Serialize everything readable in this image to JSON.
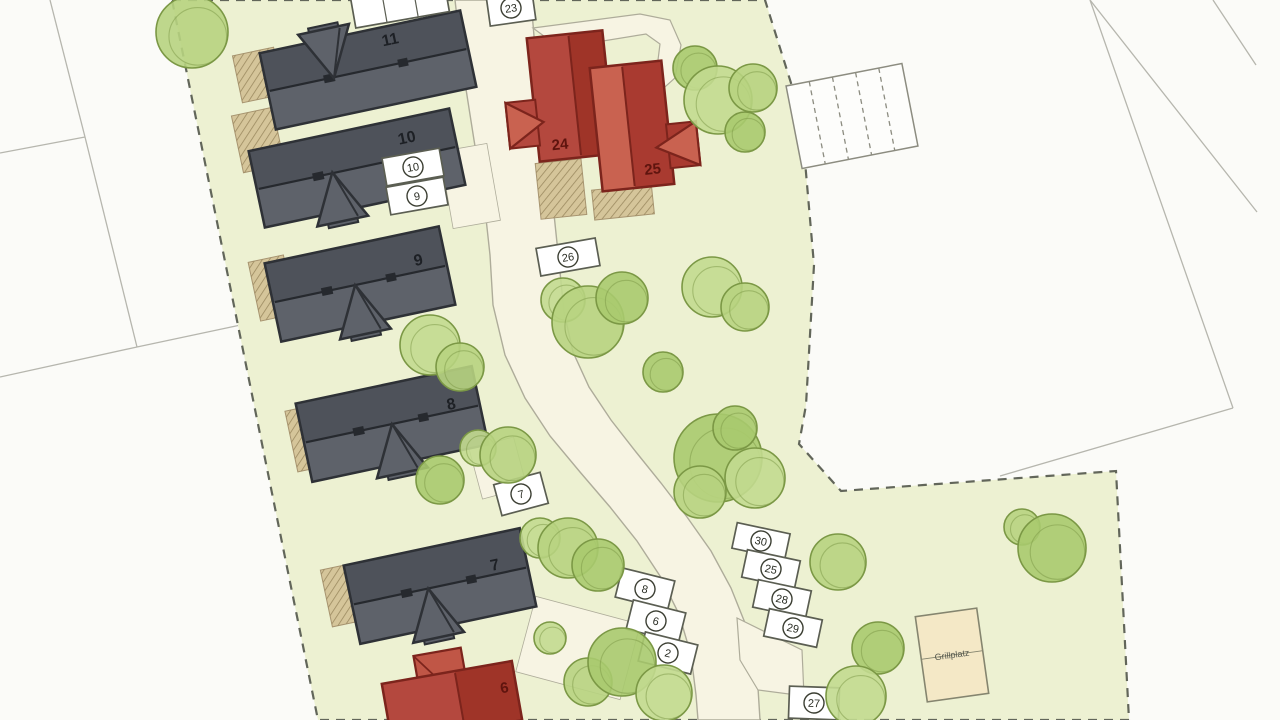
{
  "title": "housing-development-site-plan",
  "canvas": {
    "width": 1280,
    "height": 720
  },
  "colors": {
    "bg": "#fbfbf8",
    "site_fill": "#edf1d2",
    "site_boundary": "#62665a",
    "parcel_line": "#b6b6ae",
    "road_fill": "#f7f4e3",
    "road_stroke": "#aeac9a",
    "tree_fills": [
      "#b7d37f",
      "#a9ca6e",
      "#c2da8f"
    ],
    "tree_stroke": "#7b9845",
    "gray_dark": "#4e525a",
    "gray_light": "#5e626a",
    "gray_outline": "#2e3136",
    "gray_ridge": "#26292e",
    "gray_label": "#1d2025",
    "red_base": "#b4483e",
    "red_dark": "#9f3428",
    "red_light": "#c96250",
    "red_outline": "#7c241c",
    "red_label": "#5f140e",
    "terrace_fill": "#d5c59a",
    "terrace_hatch": "#9b8a60",
    "box_fill": "#ffffff",
    "box_stroke": "#5b5e52",
    "circle_stroke": "#3c3f33",
    "number_color": "#2b2e25",
    "shed_fill": "#f4e8c6",
    "shed_stroke": "#85856f",
    "shed_text": "#55584e"
  },
  "parcel_lines": [
    [
      50,
      0,
      85,
      137
    ],
    [
      85,
      137,
      0,
      153
    ],
    [
      85,
      137,
      137,
      347
    ],
    [
      137,
      347,
      0,
      377
    ],
    [
      137,
      347,
      250,
      323
    ],
    [
      1090,
      0,
      1233,
      408
    ],
    [
      1233,
      408,
      1000,
      476
    ],
    [
      1090,
      0,
      1257,
      212
    ],
    [
      1213,
      0,
      1256,
      65
    ]
  ],
  "site_polygon": "172,0 765,0 801,115 814,265 806,405 799,444 841,491 1116,471 1129,720 318,720",
  "road": {
    "main": "455,0 463,70 474,140 484,200 490,255 493,305 505,355 525,398 550,436 580,472 610,507 637,541 660,576 679,614 691,655 696,695 698,720 760,720 757,672 747,628 731,588 711,551 687,517 661,483 636,452 611,420 589,387 573,352 564,312 559,262 552,195 543,122 536,60 531,0",
    "spur_top": "533,28 640,14 670,20 681,45 675,78 656,95 641,84 657,68 660,44 646,34 560,48",
    "spur_bottom": "737,618 802,650 804,696 758,690 740,660"
  },
  "driveways": [
    [
      470,
      186,
      48,
      78,
      -10
    ],
    [
      498,
      468,
      46,
      52,
      -15
    ],
    [
      578,
      648,
      108,
      78,
      15
    ]
  ],
  "terraces": [
    [
      258,
      75,
      42,
      48,
      -12
    ],
    [
      258,
      140,
      42,
      58,
      -12
    ],
    [
      272,
      288,
      36,
      60,
      -12
    ],
    [
      308,
      438,
      34,
      62,
      -12
    ],
    [
      343,
      595,
      34,
      58,
      -12
    ],
    [
      561,
      189,
      46,
      56,
      -6
    ],
    [
      623,
      202,
      60,
      30,
      -6
    ]
  ],
  "gray_houses": [
    {
      "number": "11",
      "cx": 368,
      "cy": 70,
      "w": 205,
      "h": 78,
      "rot": -12,
      "entry": "top",
      "ex": -35,
      "lx": 28,
      "ly": -20
    },
    {
      "number": "10",
      "cx": 357,
      "cy": 168,
      "w": 205,
      "h": 78,
      "rot": -12,
      "entry": "bottom",
      "ex": -25,
      "lx": 55,
      "ly": -14
    },
    {
      "number": "9",
      "cx": 360,
      "cy": 284,
      "w": 178,
      "h": 80,
      "rot": -12,
      "entry": "bottom",
      "ex": -5,
      "lx": 62,
      "ly": -6
    },
    {
      "number": "8",
      "cx": 392,
      "cy": 424,
      "w": 180,
      "h": 80,
      "rot": -12,
      "entry": "bottom",
      "ex": 0,
      "lx": 62,
      "ly": -2
    },
    {
      "number": "7",
      "cx": 440,
      "cy": 586,
      "w": 180,
      "h": 80,
      "rot": -12,
      "entry": "bottom",
      "ex": -12,
      "lx": 58,
      "ly": -4
    }
  ],
  "red_houses": [
    {
      "number": "24",
      "cx": 571,
      "cy": 96,
      "w": 76,
      "h": 124,
      "rot": -6,
      "porch": "left",
      "split": 0.55,
      "left": "#b4483e",
      "right": "#9f3428",
      "lx": -16,
      "ly": 52
    },
    {
      "number": "25",
      "cx": 632,
      "cy": 126,
      "w": 72,
      "h": 124,
      "rot": -6,
      "porch": "right",
      "split": 0.45,
      "left": "#c96250",
      "right": "#a93a30",
      "lx": 16,
      "ly": 50
    }
  ],
  "red_house_6": {
    "number": "6",
    "cx": 452,
    "cy": 702,
    "w": 132,
    "h": 60,
    "rot": -10,
    "lx": 54,
    "ly": 0
  },
  "trees": [
    [
      192,
      32,
      36
    ],
    [
      695,
      68,
      22
    ],
    [
      718,
      100,
      34
    ],
    [
      753,
      88,
      24
    ],
    [
      745,
      132,
      20
    ],
    [
      563,
      300,
      22
    ],
    [
      588,
      322,
      36
    ],
    [
      622,
      298,
      26
    ],
    [
      712,
      287,
      30
    ],
    [
      745,
      307,
      24
    ],
    [
      663,
      372,
      20
    ],
    [
      430,
      345,
      30
    ],
    [
      460,
      367,
      24
    ],
    [
      440,
      480,
      24
    ],
    [
      478,
      448,
      18
    ],
    [
      508,
      455,
      28
    ],
    [
      718,
      458,
      44
    ],
    [
      755,
      478,
      30
    ],
    [
      700,
      492,
      26
    ],
    [
      735,
      428,
      22
    ],
    [
      540,
      538,
      20
    ],
    [
      568,
      548,
      30
    ],
    [
      598,
      565,
      26
    ],
    [
      550,
      638,
      16
    ],
    [
      588,
      682,
      24
    ],
    [
      622,
      662,
      34
    ],
    [
      664,
      693,
      28
    ],
    [
      838,
      562,
      28
    ],
    [
      878,
      648,
      26
    ],
    [
      856,
      696,
      30
    ],
    [
      1022,
      527,
      18
    ],
    [
      1052,
      548,
      34
    ]
  ],
  "parking_spaces": [
    {
      "label": "",
      "cx": 400,
      "cy": 5,
      "w": 95,
      "h": 30,
      "rot": -10,
      "divs": 2
    },
    {
      "label": "23",
      "cx": 511,
      "cy": 8,
      "w": 46,
      "h": 30,
      "rot": -8
    },
    {
      "label": "10",
      "cx": 413,
      "cy": 167,
      "w": 58,
      "h": 28,
      "rot": -10
    },
    {
      "label": "9",
      "cx": 417,
      "cy": 196,
      "w": 58,
      "h": 28,
      "rot": -10
    },
    {
      "label": "26",
      "cx": 568,
      "cy": 257,
      "w": 60,
      "h": 28,
      "rot": -10
    },
    {
      "label": "7",
      "cx": 521,
      "cy": 494,
      "w": 48,
      "h": 32,
      "rot": -15
    },
    {
      "label": "8",
      "cx": 645,
      "cy": 589,
      "w": 54,
      "h": 30,
      "rot": 14
    },
    {
      "label": "6",
      "cx": 656,
      "cy": 621,
      "w": 54,
      "h": 30,
      "rot": 14
    },
    {
      "label": "2",
      "cx": 668,
      "cy": 653,
      "w": 54,
      "h": 30,
      "rot": 14
    },
    {
      "label": "30",
      "cx": 761,
      "cy": 541,
      "w": 54,
      "h": 26,
      "rot": 12
    },
    {
      "label": "25",
      "cx": 771,
      "cy": 569,
      "w": 54,
      "h": 28,
      "rot": 12
    },
    {
      "label": "28",
      "cx": 782,
      "cy": 599,
      "w": 54,
      "h": 28,
      "rot": 12
    },
    {
      "label": "29",
      "cx": 793,
      "cy": 628,
      "w": 54,
      "h": 28,
      "rot": 12
    },
    {
      "label": "27",
      "cx": 814,
      "cy": 703,
      "w": 50,
      "h": 32,
      "rot": 2
    }
  ],
  "parking_row": {
    "cx": 852,
    "cy": 116,
    "w": 118,
    "h": 84,
    "rot": -11,
    "stalls": 5
  },
  "shed": {
    "label": "Grillplatz",
    "cx": 952,
    "cy": 655,
    "w": 62,
    "h": 86,
    "rot": -8
  }
}
